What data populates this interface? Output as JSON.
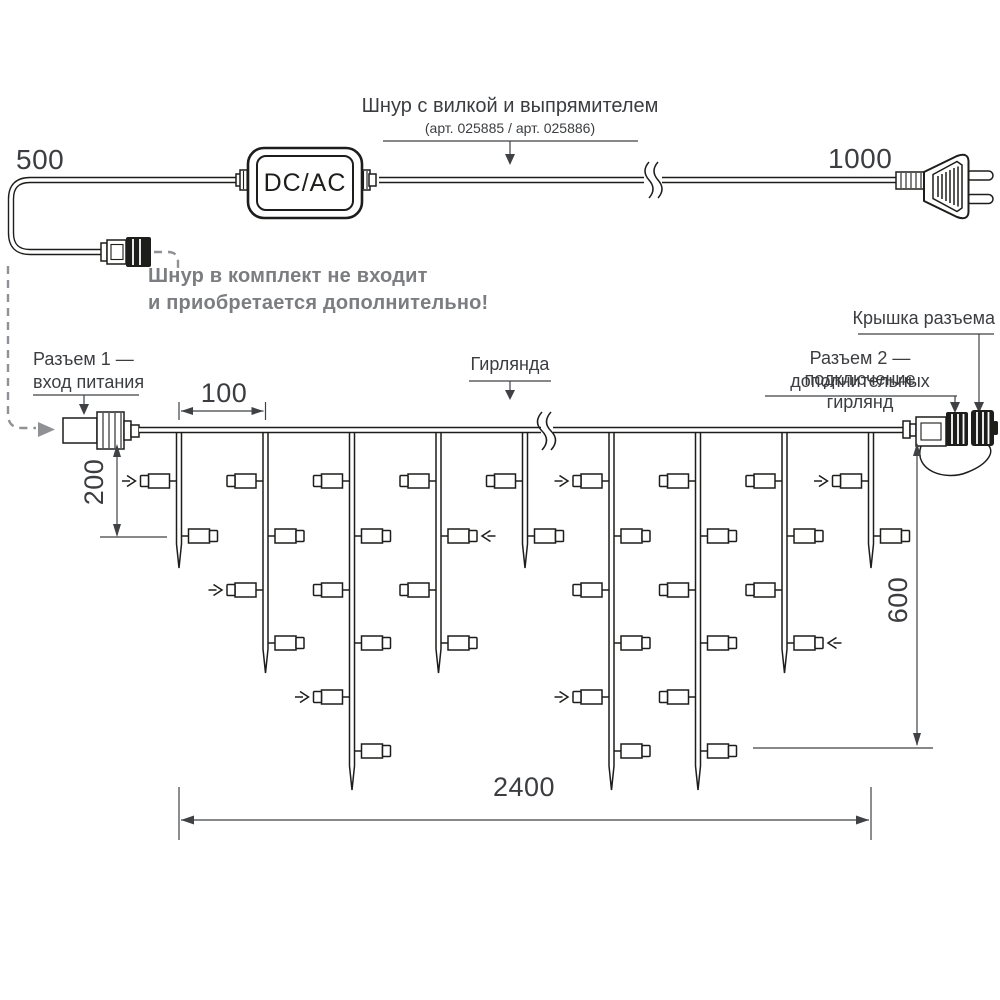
{
  "top": {
    "dim_left": "500",
    "dim_right": "1000",
    "converter_label": "DC/AC",
    "title_line1": "Шнур с вилкой и выпрямителем",
    "title_line2": "(арт. 025885 / арт. 025886)",
    "note_line1": "Шнур в комплект не входит",
    "note_line2": "и приобретается дополнительно!"
  },
  "labels": {
    "connector1_line1": "Разъем 1 —",
    "connector1_line2": "вход питания",
    "garland": "Гирлянда",
    "cap": "Крышка разъема",
    "connector2_line1": "Разъем 2 — подключение",
    "connector2_line2": "дополнительных гирлянд"
  },
  "dimensions": {
    "drop_spacing": "100",
    "first_drop": "200",
    "max_drop": "600",
    "length": "2400"
  },
  "colors": {
    "ink": "#1d1d1b",
    "note_gray": "#7b7d80",
    "dash_gray": "#8f9194",
    "leader": "#3f4145"
  },
  "garland": {
    "wire_y": 430,
    "drop_start_x": 179,
    "drop_spacing": 86.5,
    "lamp_rows_y": [
      481,
      536,
      590,
      643,
      697,
      751
    ],
    "drops": [
      {
        "lamps": 2,
        "tip_y": 568
      },
      {
        "lamps": 4,
        "tip_y": 673
      },
      {
        "lamps": 6,
        "tip_y": 790
      },
      {
        "lamps": 4,
        "tip_y": 673
      },
      {
        "lamps": 2,
        "tip_y": 568
      },
      {
        "lamps": 6,
        "tip_y": 790
      },
      {
        "lamps": 6,
        "tip_y": 790
      },
      {
        "lamps": 4,
        "tip_y": 673
      },
      {
        "lamps": 2,
        "tip_y": 568
      }
    ],
    "flash_arrows": [
      {
        "drop": 1,
        "row": 1
      },
      {
        "drop": 2,
        "row": 3
      },
      {
        "drop": 3,
        "row": 5
      },
      {
        "drop": 4,
        "row": 2
      },
      {
        "drop": 6,
        "row": 1
      },
      {
        "drop": 6,
        "row": 5
      },
      {
        "drop": 8,
        "row": 4
      },
      {
        "drop": 9,
        "row": 1
      }
    ]
  }
}
